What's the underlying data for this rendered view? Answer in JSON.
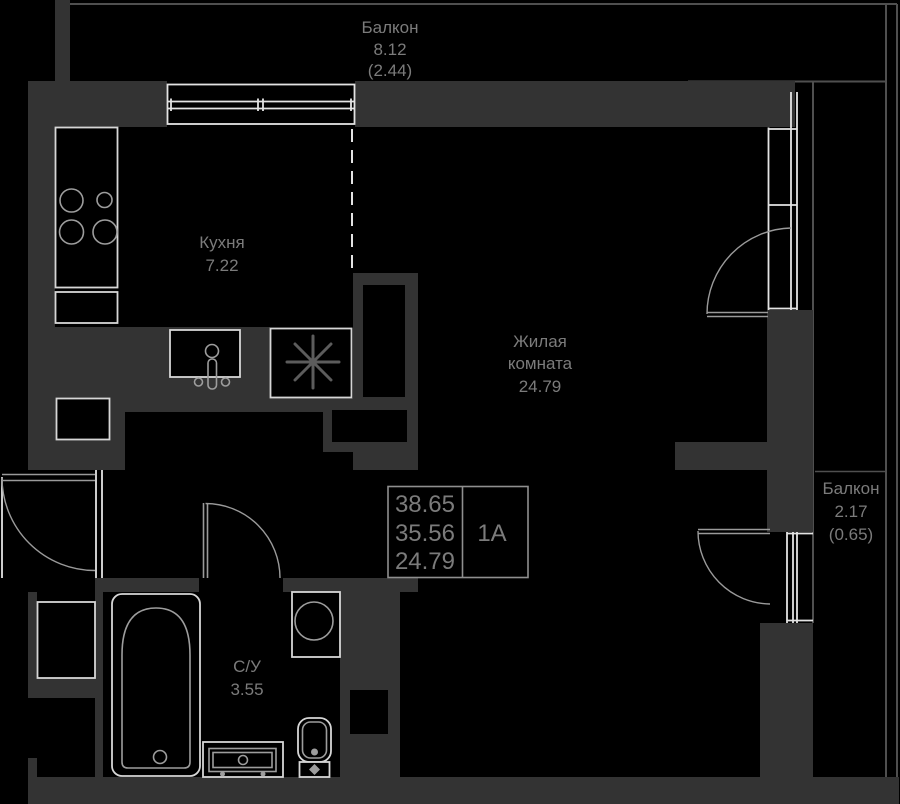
{
  "rooms": {
    "balcony_top": {
      "name": "Балкон",
      "area": "8.12",
      "reduced": "(2.44)"
    },
    "kitchen": {
      "name": "Кухня",
      "area": "7.22"
    },
    "living": {
      "line1": "Жилая",
      "line2": "комната",
      "area": "24.79"
    },
    "balcony_right": {
      "name": "Балкон",
      "area": "2.17",
      "reduced": "(0.65)"
    },
    "bathroom": {
      "name": "С/У",
      "area": "3.55"
    }
  },
  "info_box": {
    "total_area": "38.65",
    "living_area_total": "35.56",
    "room_area": "24.79",
    "unit": "1А"
  },
  "colors": {
    "bg": "#000000",
    "wall": "#333333",
    "line": "#4f4f4f",
    "window": "#e3e3e3",
    "fixture": "#d6d6d6",
    "fixture2": "#9d9d9d",
    "arc": "#9a9a9a",
    "text": "#7b7b7b",
    "box": "#8f8f8f",
    "star": "#5c5c5c"
  }
}
